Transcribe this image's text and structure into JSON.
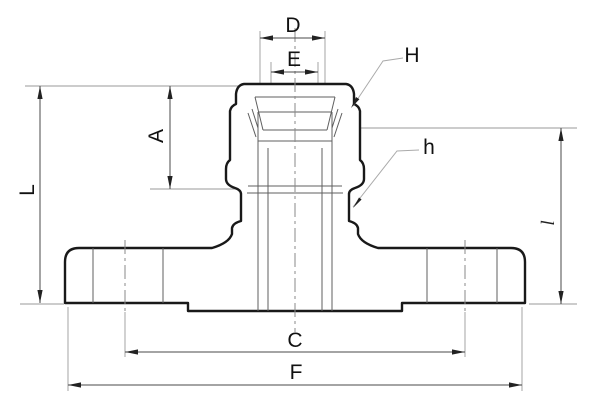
{
  "drawing": {
    "background": "#ffffff",
    "outline_color": "#191919",
    "thin_line_color": "#5f5f5f",
    "dimension_line_color": "#4a4a4a",
    "extension_line_color": "#9a9a9a",
    "labels": {
      "D": "D",
      "E": "E",
      "H": "H",
      "A": "A",
      "h": "h",
      "L": "L",
      "l": "l",
      "C": "C",
      "F": "F"
    },
    "dimensions": [
      {
        "id": "D",
        "label": "D",
        "orientation": "horizontal",
        "position": "top"
      },
      {
        "id": "E",
        "label": "E",
        "orientation": "horizontal",
        "position": "top-inner"
      },
      {
        "id": "A",
        "label": "A",
        "orientation": "vertical",
        "position": "upper-left"
      },
      {
        "id": "L",
        "label": "L",
        "orientation": "vertical",
        "position": "far-left"
      },
      {
        "id": "l",
        "label": "l",
        "orientation": "vertical",
        "position": "far-right"
      },
      {
        "id": "C",
        "label": "C",
        "orientation": "horizontal",
        "position": "bottom"
      },
      {
        "id": "F",
        "label": "F",
        "orientation": "horizontal",
        "position": "bottom-outer"
      }
    ],
    "callouts": [
      {
        "id": "H",
        "label": "H",
        "target": "nut-upper-hex"
      },
      {
        "id": "h",
        "label": "h",
        "target": "body-lower-hex"
      }
    ]
  }
}
